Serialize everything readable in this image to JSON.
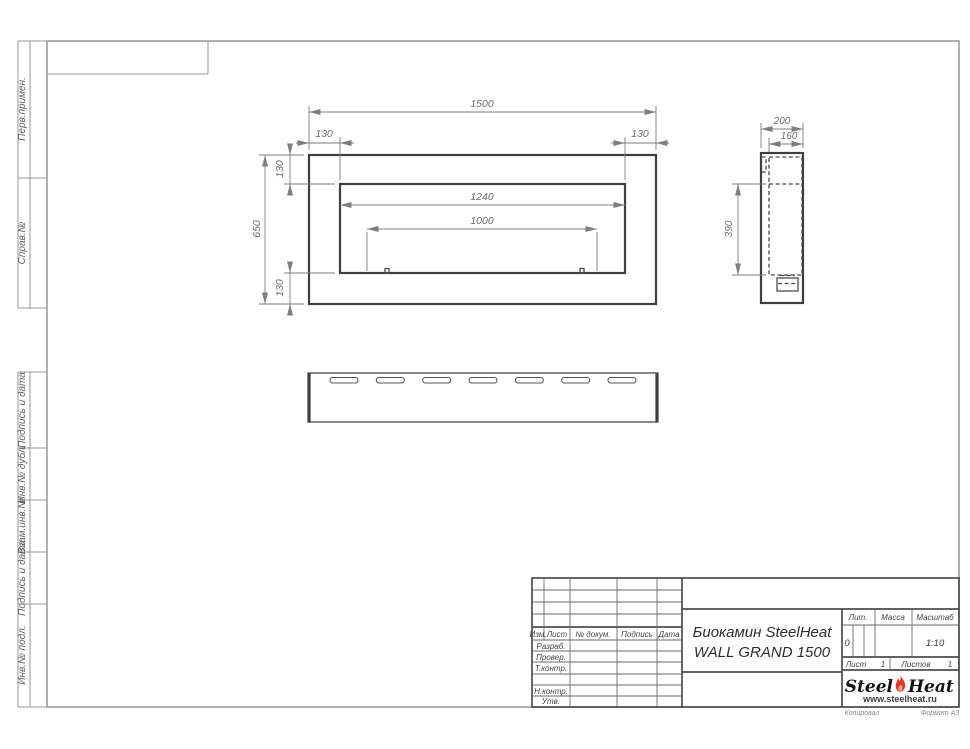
{
  "document": {
    "title_line1": "Биокамин SteelHeat",
    "title_line2": "WALL GRAND 1500",
    "stamp": {
      "header_cols": [
        "Изм.",
        "Лист",
        "№ докум.",
        "Подпись",
        "Дата"
      ],
      "rows": [
        "Разраб.",
        "Провер.",
        "Т.контр.",
        "",
        "Н.контр.",
        "Утв."
      ],
      "lit_label": "Лит.",
      "lit_value": "0",
      "mass_label": "Масса",
      "scale_label": "Масштаб",
      "scale_value": "1:10",
      "sheet_label": "Лист",
      "sheet_value": "1",
      "sheets_label": "Листов",
      "sheets_value": "1",
      "copied_label": "Копировал",
      "format_label": "Формат А3"
    },
    "margins": {
      "top": [
        "Перв.примен.",
        "Справ.№"
      ],
      "bottom": [
        "Подпись и дата",
        "Инв.№ дубл.",
        "Взам.инв.№",
        "Подпись и дата",
        "Инв.№ подл."
      ]
    },
    "logo": {
      "steel": "Steel",
      "heat": "Heat",
      "url": "www.steelheat.ru",
      "flame_color": "#e2331f"
    }
  },
  "drawing": {
    "front_view": {
      "overall_width": "1500",
      "overall_height": "650",
      "top_offset_left": "130",
      "top_offset_right": "130",
      "side_offset_top": "130",
      "side_offset_bottom": "130",
      "opening_width": "1240",
      "burner_width": "1000"
    },
    "side_view": {
      "depth": "200",
      "inner_depth": "160",
      "opening_height": "390"
    }
  }
}
